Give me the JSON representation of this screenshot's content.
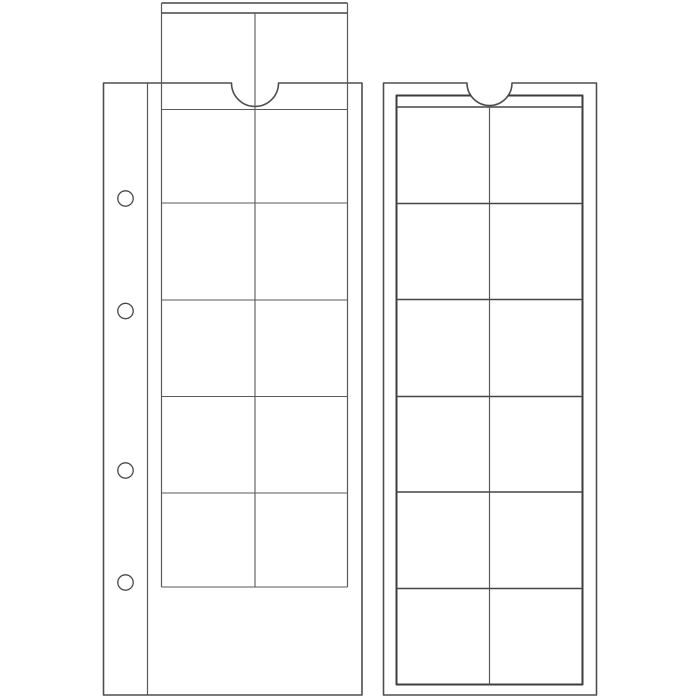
{
  "colors": {
    "background": "#ffffff",
    "page_outline": "#4e4e4e",
    "thin_line": "#5a5a5a",
    "medium_line": "#474747",
    "grid_outline": "#3d3d3d"
  },
  "left_sheet": {
    "type": "coin pocket sheet with sliding insert pulled out at top",
    "visible_pocket_rows": 5,
    "pocket_columns": 2,
    "binder_holes": 4,
    "has_thumb_notch": true,
    "slider_visible": true
  },
  "right_sheet": {
    "type": "coin pocket sheet",
    "pocket_rows": 6,
    "pocket_columns": 2,
    "binder_holes": 0,
    "has_thumb_notch": true
  }
}
